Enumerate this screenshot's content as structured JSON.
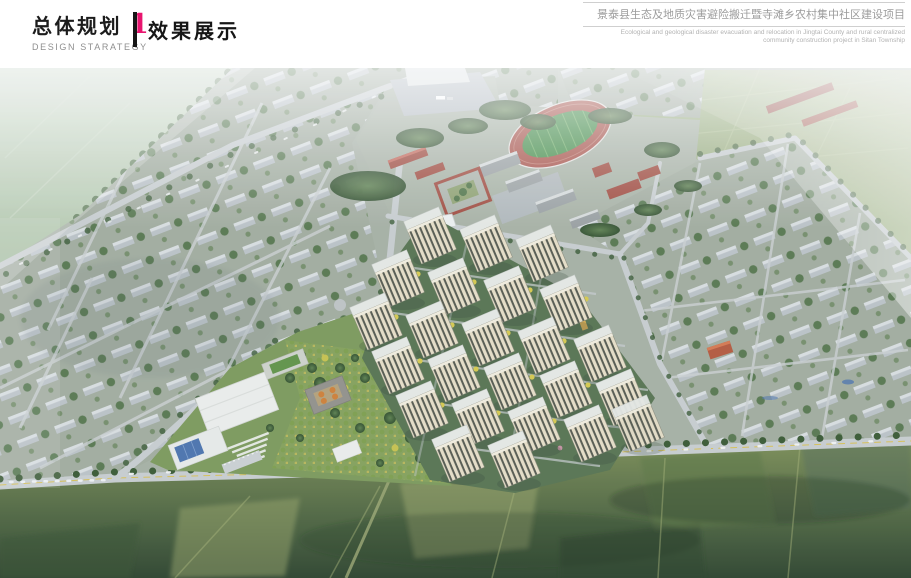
{
  "header": {
    "section_title_zh": "总体规划",
    "section_number": "1",
    "section_subtitle_en": "DESIGN STARATEGY",
    "page_title_zh": "效果展示",
    "project_title_zh": "景泰县生态及地质灾害避险搬迁暨寺滩乡农村集中社区建设项目",
    "project_subtitle_en_line1": "Ecological and geological disaster evacuation and relocation in Jingtai County and rural centralized",
    "project_subtitle_en_line2": "community construction project in Sitan Township"
  },
  "colors": {
    "accent": "#e8156f",
    "divider": "#161616",
    "rule": "#cfcfcf",
    "track_red": "#a85148",
    "track_green": "#438c48",
    "facade_cream": "#e7dfc8",
    "farm_dark": "#2e442e"
  }
}
